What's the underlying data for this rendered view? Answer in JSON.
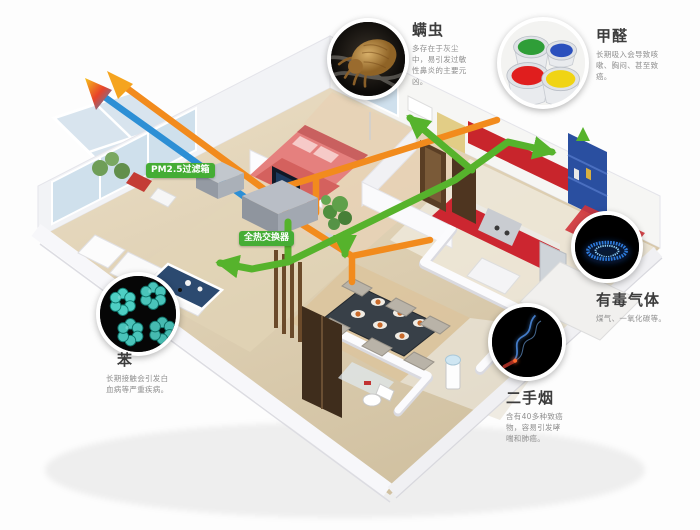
{
  "canvas": {
    "width": 700,
    "height": 530
  },
  "system_labels": {
    "filter_box": "PM2.5过滤箱",
    "heat_exchanger": "全热交换器"
  },
  "pollutants": [
    {
      "id": "dust-mite",
      "title": "螨虫",
      "desc": "多存在于灰尘中，易引发过敏性鼻炎的主要元凶。",
      "photo": "dust-mite-microscope-photo"
    },
    {
      "id": "formaldehyde",
      "title": "甲醛",
      "desc": "长期吸入会导致咳嗽、胸闷、甚至致癌。",
      "photo": "paint-buckets-photo"
    },
    {
      "id": "toxic-gas",
      "title": "有毒气体",
      "desc": "煤气、一氧化碳等。",
      "photo": "gas-burner-blue-flame-photo"
    },
    {
      "id": "secondhand-smoke",
      "title": "二手烟",
      "desc": "含有40多种致癌物，容易引发哮喘和肺癌。",
      "photo": "cigarette-smoke-photo"
    },
    {
      "id": "benzene",
      "title": "苯",
      "desc": "长期接触会引发白血病等严重疾病。",
      "photo": "benzene-molecule-model-photo"
    }
  ],
  "colors": {
    "supply_duct": "#56b32c",
    "return_duct": "#f28b1d",
    "intake_duct": "#2d8fd5",
    "label_chip": "#45ad35",
    "title_text": "#3c3c3c",
    "desc_text": "#8e8e8e"
  }
}
